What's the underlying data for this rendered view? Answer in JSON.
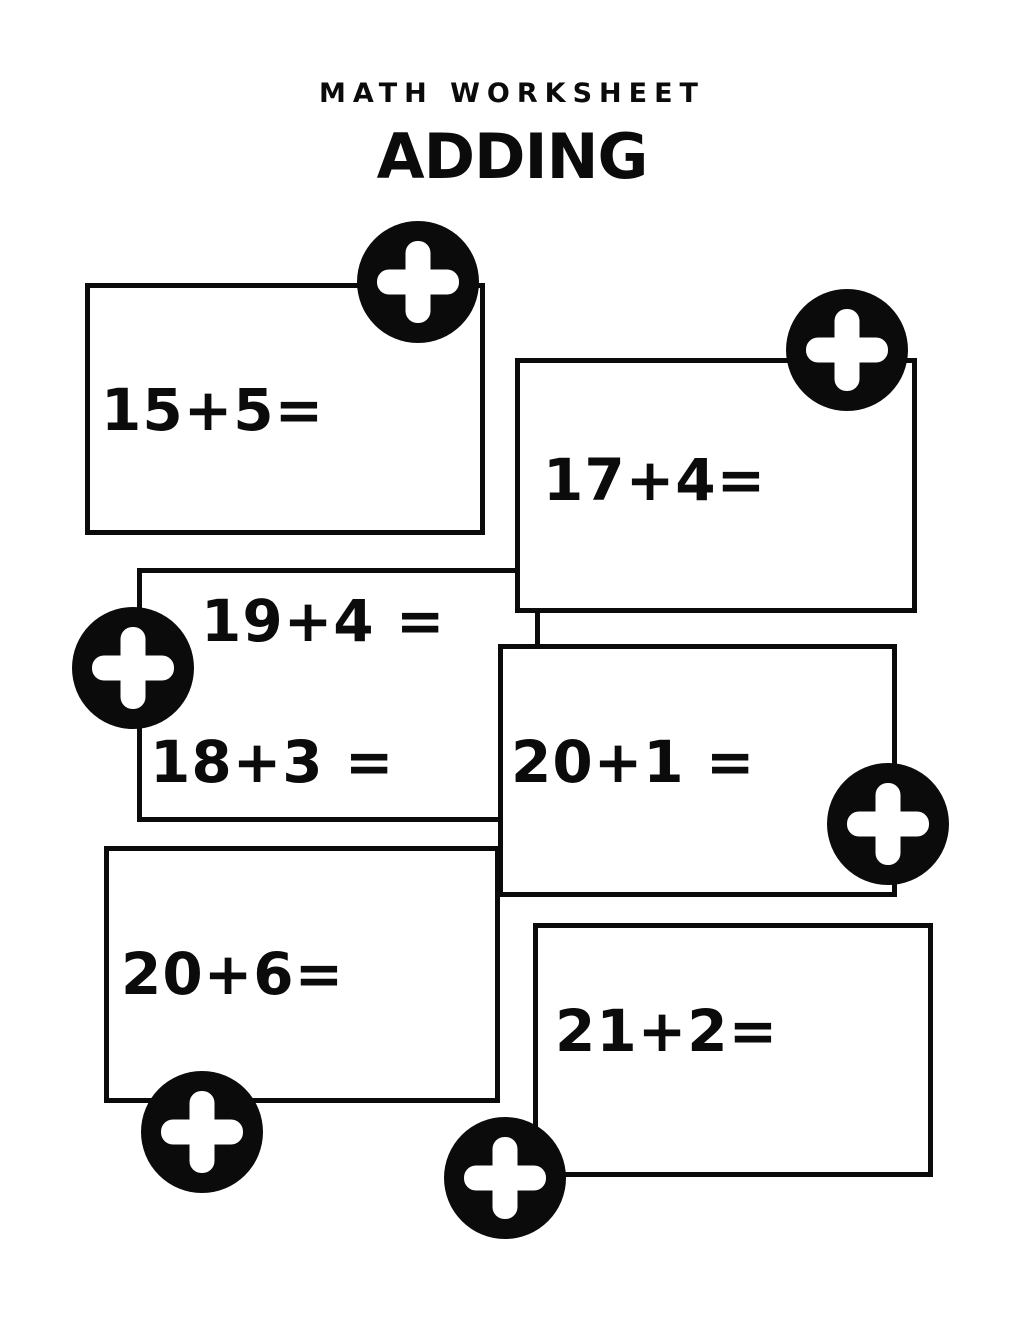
{
  "header": {
    "kicker": "MATH WORKSHEET",
    "title": "ADDING"
  },
  "colors": {
    "ink": "#0b0b0b",
    "paper": "#ffffff"
  },
  "icons": {
    "plus_badge": {
      "name": "plus-icon",
      "glyph": "+"
    }
  },
  "boxes": [
    {
      "equations": [
        "15+5="
      ]
    },
    {
      "equations": [
        "17+4="
      ]
    },
    {
      "equations": [
        "19+4 =",
        "18+3 ="
      ]
    },
    {
      "equations": [
        "20+1 ="
      ]
    },
    {
      "equations": [
        "20+6="
      ]
    },
    {
      "equations": [
        "21+2="
      ]
    }
  ]
}
